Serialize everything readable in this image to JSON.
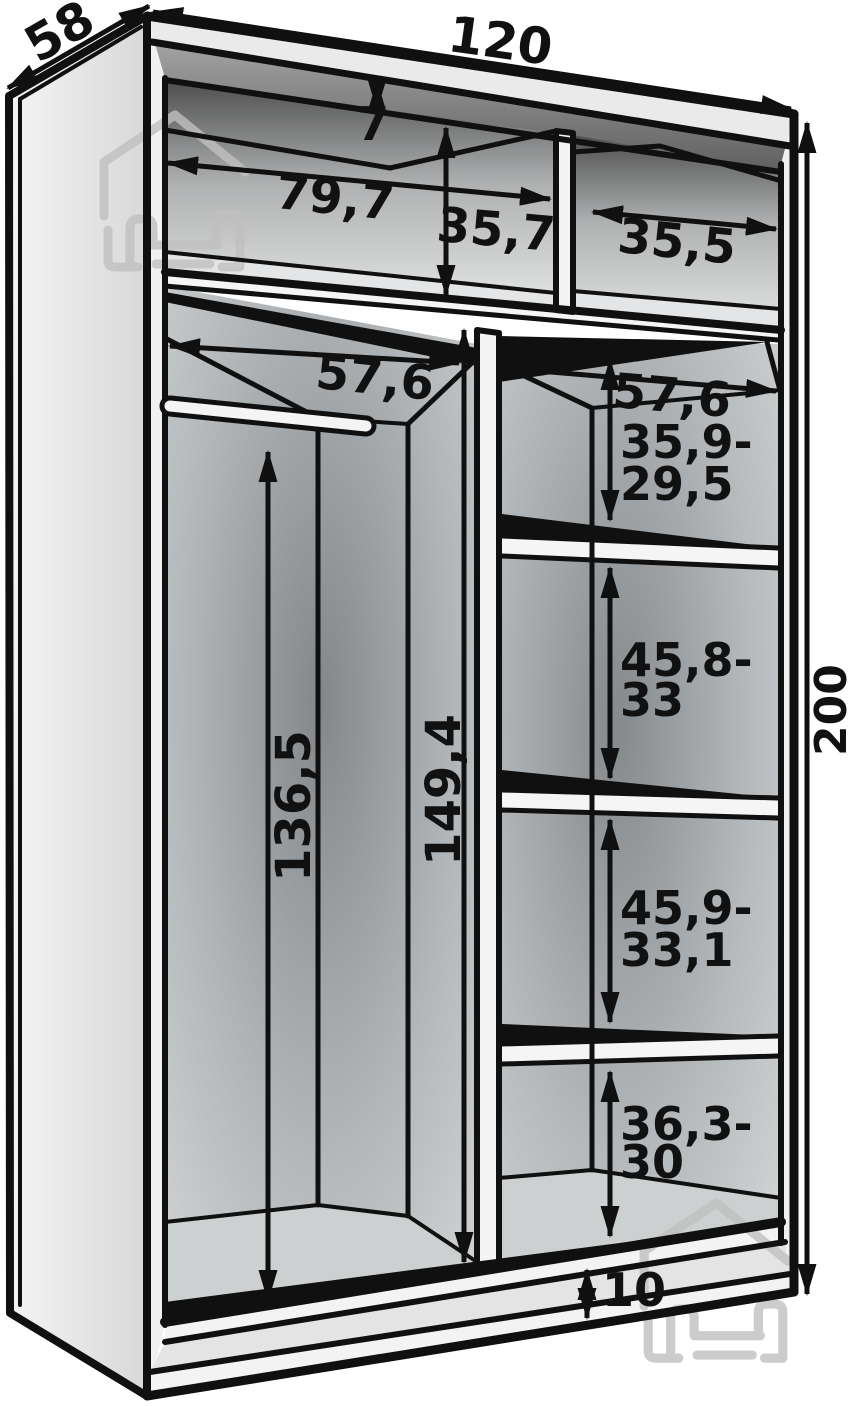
{
  "figure": {
    "type": "wardrobe-interior-dimension-diagram",
    "description": "Perspective line drawing of a two-section sliding wardrobe carcass with shelves, hanging rail and dimension arrows"
  },
  "dimensions": {
    "overall_width": "120",
    "overall_depth": "58",
    "overall_height": "200",
    "top_gap": "7",
    "upper_left_width": "79,7",
    "upper_left_height": "35,7",
    "upper_right_width": "35,5",
    "left_section_width": "57,6",
    "right_section_width": "57,6",
    "hanging_clearance": "136,5",
    "divider_height": "149,4",
    "shelf_gaps": [
      {
        "line1": "35,9-",
        "line2": "29,5"
      },
      {
        "line1": "45,8-",
        "line2": "33"
      },
      {
        "line1": "45,9-",
        "line2": "33,1"
      },
      {
        "line1": "36,3-",
        "line2": "30"
      }
    ],
    "plinth_height": "10"
  },
  "watermark": {
    "icon": "furniture-house-bed-logo",
    "positions": [
      "top-left",
      "bottom-right"
    ]
  },
  "colors": {
    "background": "#ffffff",
    "line": "#101010",
    "panel_light": "#f0f0f0",
    "interior_dark": "#84888a",
    "watermark": "#c0c0c0"
  }
}
